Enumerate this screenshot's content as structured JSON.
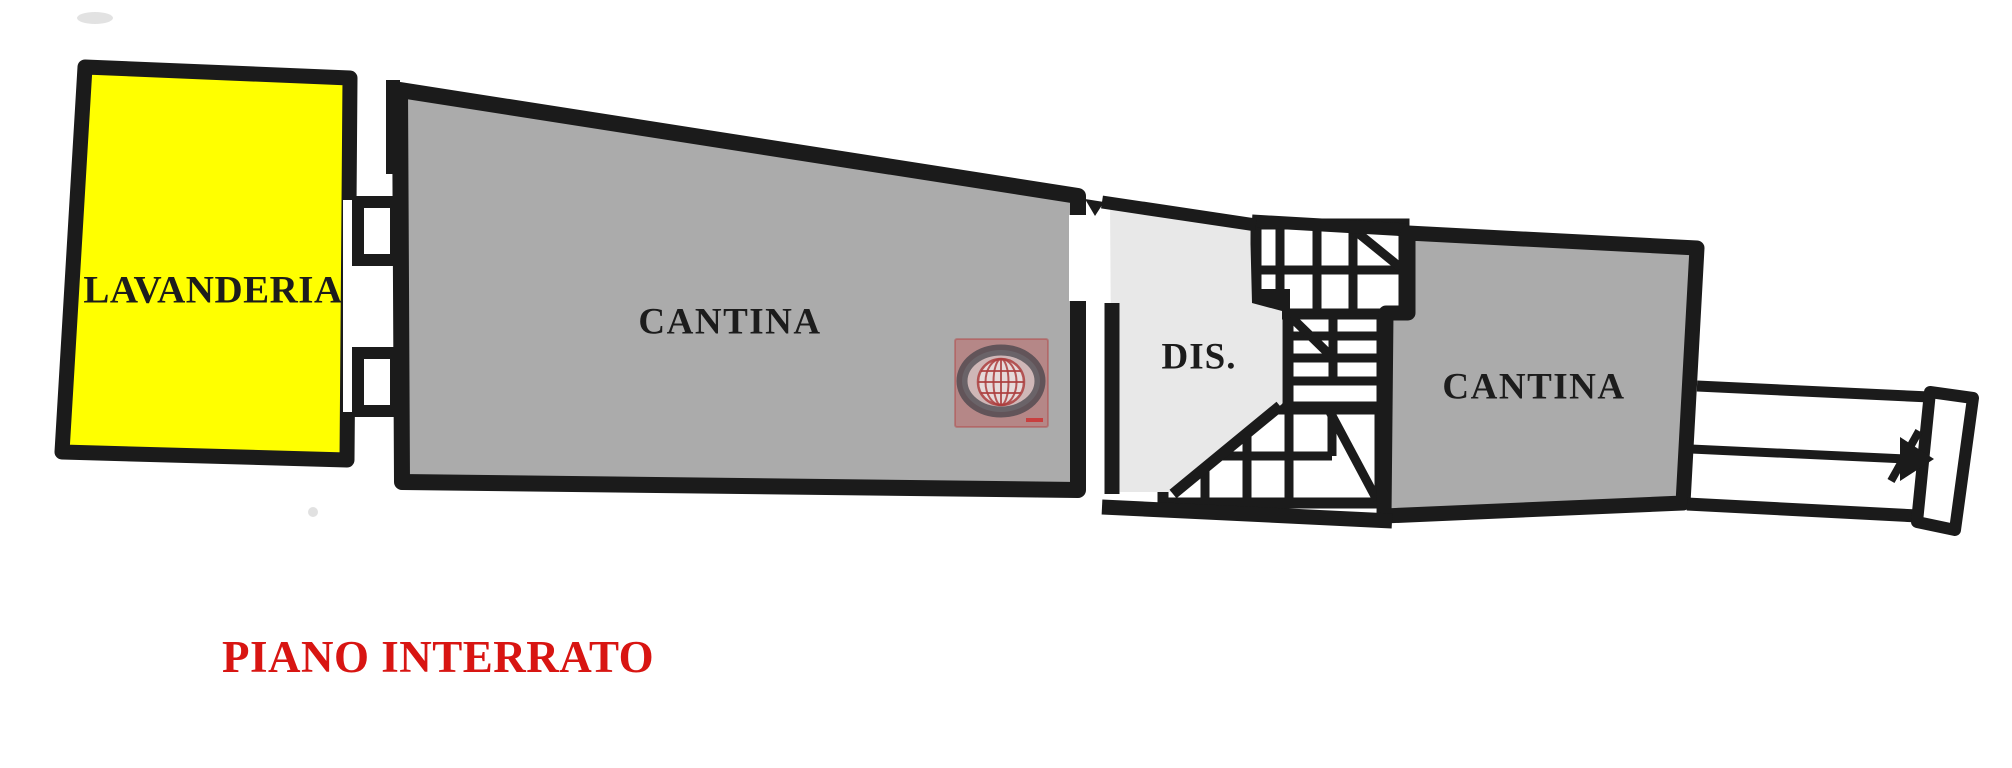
{
  "page": {
    "background_color": "#ffffff",
    "wall_color": "#1b1b1b"
  },
  "floor_plan": {
    "title": "PIANO INTERRATO",
    "title_color": "#d81512",
    "rooms": [
      {
        "label": "LAVANDERIA",
        "fill": "#ffff00"
      },
      {
        "label": "CANTINA",
        "fill": "#ababab"
      },
      {
        "label": "DIS.",
        "fill": "#e8e8e8"
      },
      {
        "label": "CANTINA",
        "fill": "#ababab"
      }
    ],
    "features": {
      "staircase": "winding-staircase",
      "ramp": "double-lane-ramp-with-direction-arrow"
    },
    "watermark": {
      "name": "globe-logo",
      "square_color": "#c85a5a",
      "ring_color": "#46464e",
      "globe_color": "#b05050"
    }
  }
}
